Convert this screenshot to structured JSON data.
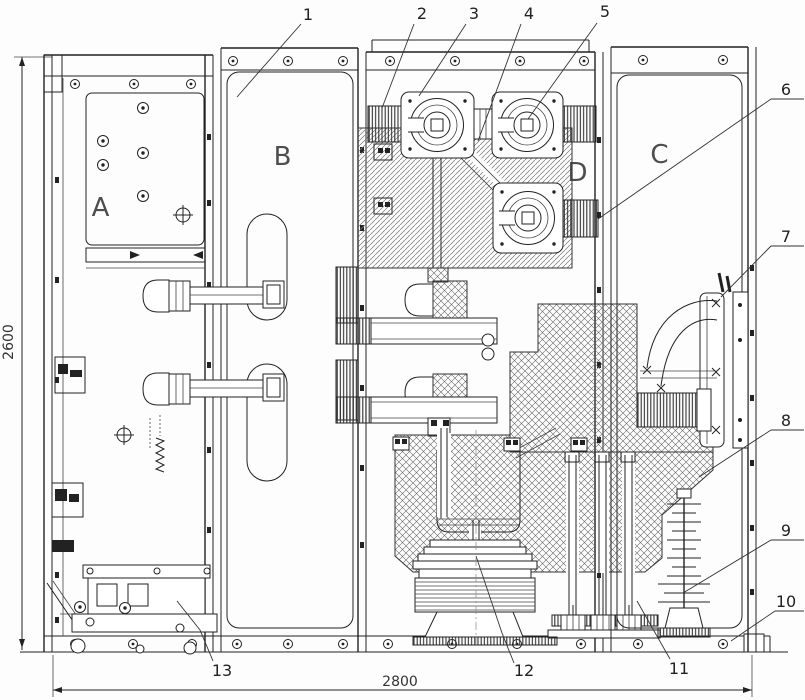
{
  "labels": {
    "compartments": {
      "a": "A",
      "b": "B",
      "c": "C",
      "d": "D"
    },
    "callouts": [
      "1",
      "2",
      "3",
      "4",
      "5",
      "6",
      "7",
      "8",
      "9",
      "10",
      "11",
      "12",
      "13"
    ],
    "dimensions": {
      "height": "2600",
      "width": "2800"
    }
  }
}
